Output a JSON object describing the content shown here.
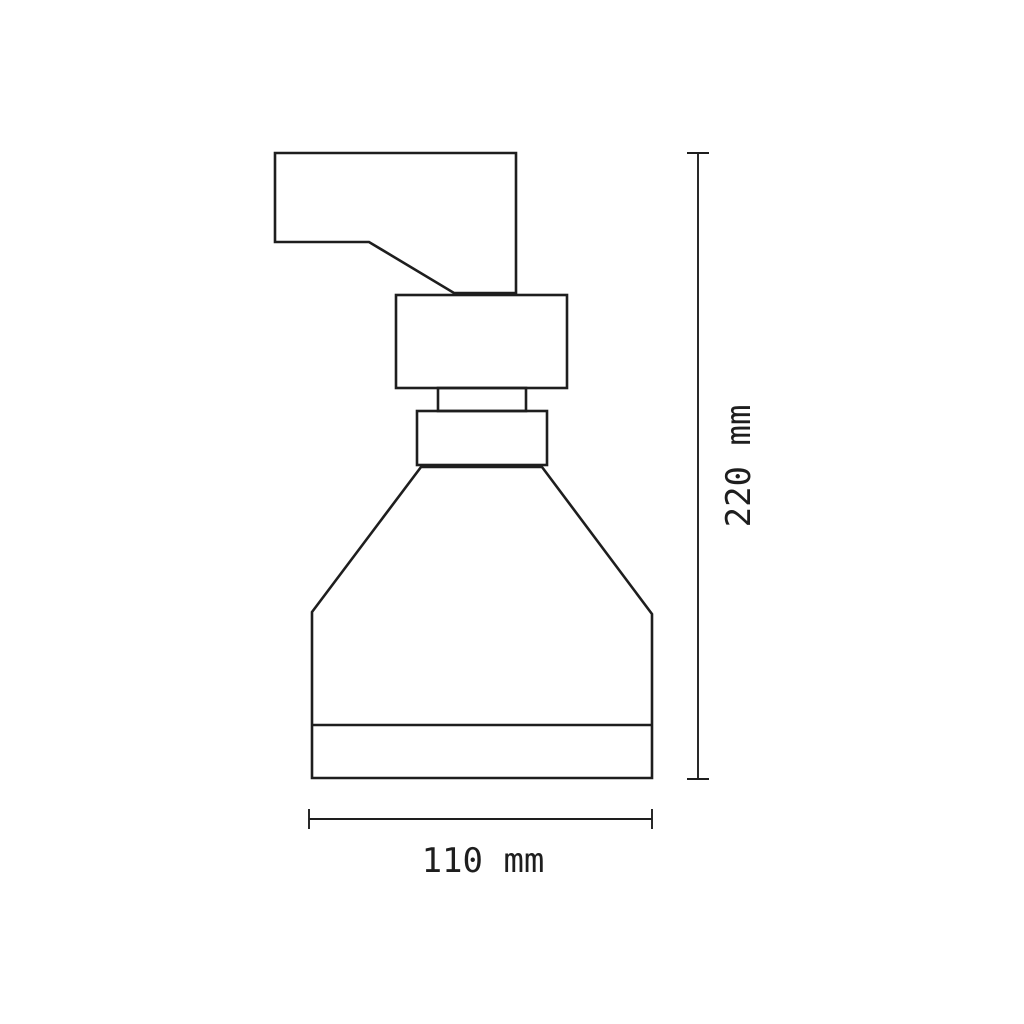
{
  "page": {
    "background_color": "#ffffff",
    "line_color": "#1e1e1e"
  },
  "drawing": {
    "subject": "spotlight-fixture-side-view",
    "parts": [
      "mounting-arm",
      "adapter-block",
      "neck",
      "collar-ring",
      "lamp-shade",
      "shade-bottom-rim"
    ],
    "dimensions": {
      "height": {
        "value": "220",
        "unit": "mm",
        "label": "220 mm"
      },
      "width": {
        "value": "110",
        "unit": "mm",
        "label": "110 mm"
      }
    }
  }
}
